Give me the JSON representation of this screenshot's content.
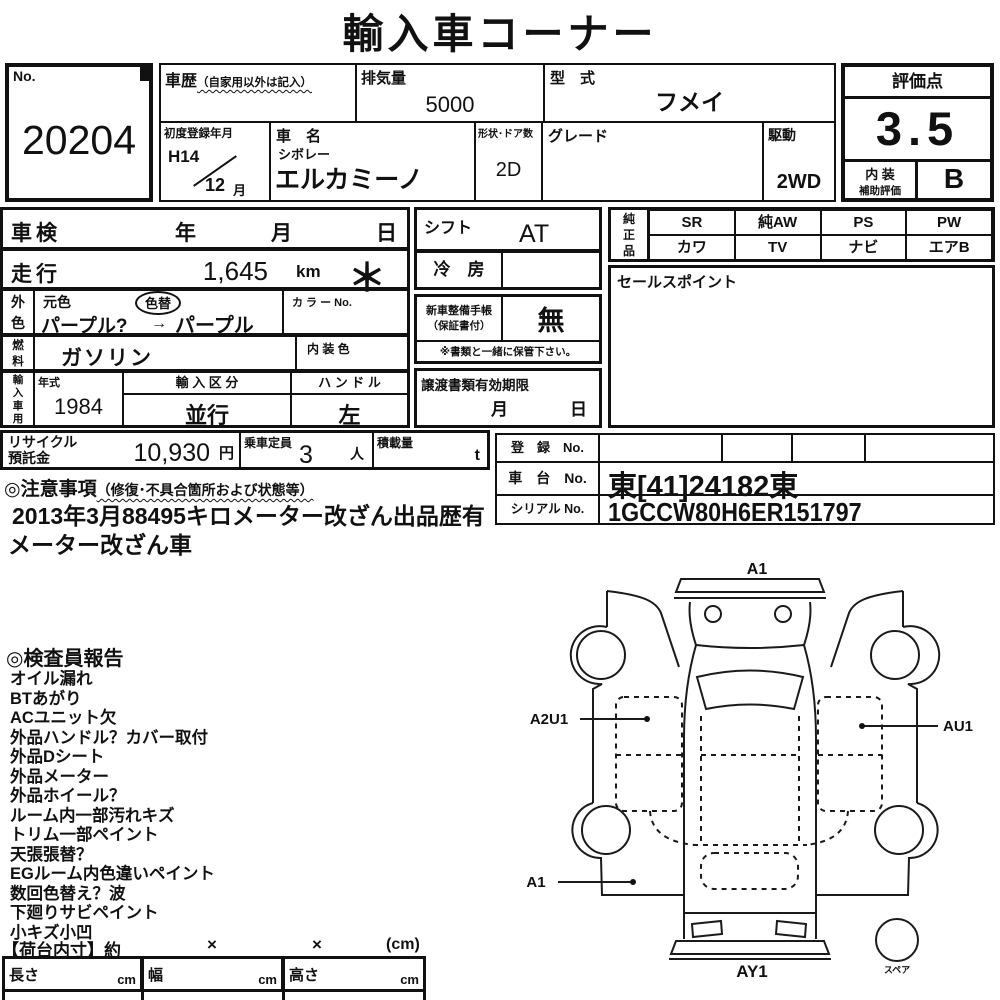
{
  "title": "輸入車コーナー",
  "no_box": {
    "label": "No.",
    "value": "20204"
  },
  "main": {
    "history_label": "車歴",
    "history_note": "（自家用以外は記入）",
    "displacement_label": "排気量",
    "displacement_value": "5000",
    "model_label": "型　式",
    "model_value": "フメイ",
    "first_reg_label": "初度登録年月",
    "first_reg_year": "H14",
    "first_reg_month": "12",
    "first_reg_month_suffix": "月",
    "name_label": "車　名",
    "maker": "シボレー",
    "name_value": "エルカミーノ",
    "shape_doors_label": "形状･ドア数",
    "shape_doors_value": "2D",
    "grade_label": "グレード",
    "drive_label": "駆動",
    "drive_value": "2WD"
  },
  "rating": {
    "label": "評価点",
    "score": "3.5",
    "interior_label_1": "内 装",
    "interior_label_2": "補助評価",
    "interior_grade": "B"
  },
  "left": {
    "shaken_label": "車検",
    "year": "年",
    "month": "月",
    "day": "日",
    "mileage_label": "走行",
    "mileage_value": "1,645",
    "mileage_unit": "km",
    "asterisk": "＊",
    "ext_color_1": "外",
    "ext_color_2": "色",
    "base_color_label": "元色",
    "color_change_label": "色替",
    "color_from": "パープル?",
    "arrow": "→",
    "color_to": "パープル",
    "color_no_label": "カ ラ ー No.",
    "fuel_1": "燃",
    "fuel_2": "料",
    "fuel_value": "ガソリン",
    "interior_color_label": "内 装 色",
    "import_1": "輸",
    "import_2": "入",
    "import_3": "車",
    "import_4": "用",
    "year_model_label": "年式",
    "year_model_value": "1984",
    "import_class_label": "輸 入 区 分",
    "import_class_value": "並行",
    "handle_label": "ハ ン ド ル",
    "handle_value": "左"
  },
  "mid": {
    "shift_label": "シフト",
    "shift_value": "AT",
    "ac_label": "冷　房",
    "service_book_1": "新車整備手帳",
    "service_book_2": "（保証書付）",
    "service_book_value": "無",
    "keep_note": "※書類と一緒に保管下さい。",
    "transfer_label": "譲渡書類有効期限",
    "transfer_month": "月",
    "transfer_day": "日"
  },
  "oem": {
    "label_1": "純",
    "label_2": "正",
    "label_3": "品",
    "row1": [
      "SR",
      "純AW",
      "PS",
      "PW"
    ],
    "row2": [
      "カワ",
      "TV",
      "ナビ",
      "エアB"
    ]
  },
  "sales_point_label": "セールスポイント",
  "reg": {
    "reg_no_label": "登　録　No.",
    "chassis_no_label": "車　台　No.",
    "chassis_no_value": "東[41]24182東",
    "serial_no_label": "シリアル No.",
    "serial_no_value": "1GCCW80H6ER151797"
  },
  "recycle": {
    "label_1": "リサイクル",
    "label_2": "預託金",
    "value": "10,930",
    "unit": "円",
    "capacity_label": "乗車定員",
    "capacity_value": "3",
    "capacity_unit": "人",
    "load_label": "積載量",
    "load_unit": "t"
  },
  "notes": {
    "heading": "◎注意事項",
    "heading_note": "（修復･不具合箇所および状態等）",
    "line1": "2013年3月88495キロメーター改ざん出品歴有",
    "line2": "メーター改ざん車"
  },
  "report": {
    "heading": "◎検査員報告",
    "items": [
      "オイル漏れ",
      "BTあがり",
      "ACユニット欠",
      "外品ハンドル？カバー取付",
      "外品Dシート",
      "外品メーター",
      "外品ホイール？",
      "ルーム内一部汚れキズ",
      "トリム一部ペイント",
      "天張張替？",
      "EGルーム内色違いペイント",
      "数回色替え？波",
      "下廻りサビペイント",
      "小キズ小凹"
    ]
  },
  "bed": {
    "heading": "【荷台内寸】約",
    "x1": "×",
    "x2": "×",
    "unit": "(cm)",
    "length_label": "長さ",
    "width_label": "幅",
    "height_label": "高さ",
    "cm": "cm"
  },
  "diagram": {
    "label_a1_top": "A1",
    "label_a2u1": "A2U1",
    "label_au1": "AU1",
    "label_a1_bottom": "A1",
    "label_ay1": "AY1",
    "label_spare": "スペア"
  }
}
